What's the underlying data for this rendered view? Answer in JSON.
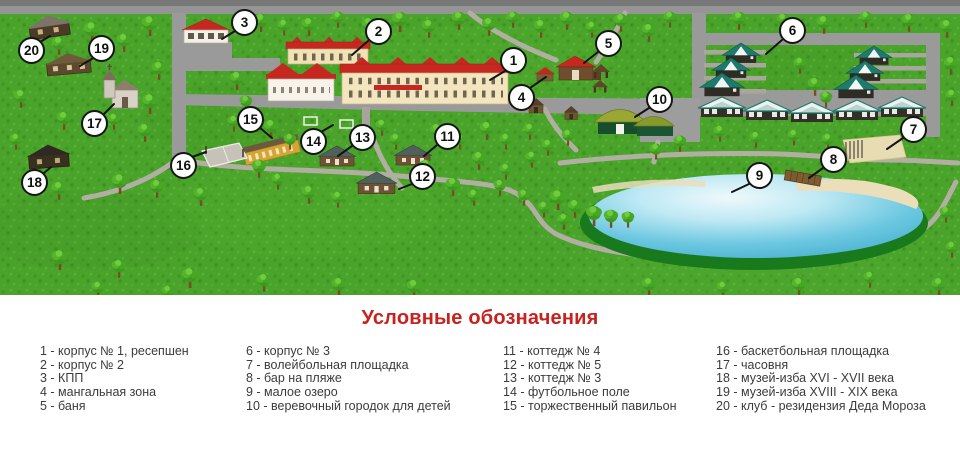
{
  "colors": {
    "accent_red": "#c8211e",
    "grass_green": "#4aa32b",
    "road_gray": "#9a9a9a",
    "lake_blue": "#5fc3de"
  },
  "callouts": [
    "1",
    "2",
    "3",
    "4",
    "5",
    "6",
    "7",
    "8",
    "9",
    "10",
    "11",
    "12",
    "13",
    "14",
    "15",
    "16",
    "17",
    "18",
    "19",
    "20"
  ],
  "legend": {
    "title": "Условные обозначения",
    "columns": [
      {
        "items": [
          "1 - корпус № 1, ресепшен",
          "2 - корпус № 2",
          "3 - КПП",
          "4 - мангальная зона",
          "5 - баня"
        ]
      },
      {
        "items": [
          "6 - корпус № 3",
          "7 - волейбольная площадка",
          "8 - бар на пляже",
          "9 - малое озеро",
          "10 - веревочный городок для детей"
        ]
      },
      {
        "items": [
          "11 - коттедж № 4",
          "12 - коттедж № 5",
          "13 - коттедж № 3",
          "14 - футбольное поле",
          "15 - торжественный павильон"
        ]
      },
      {
        "items": [
          "16 - баскетбольная площадка",
          "17 - часовня",
          "18 - музей-изба XVI - XVII века",
          "19 - музей-изба XVIII - XIX века",
          "20 - клуб - резидензия Деда Мороза"
        ]
      }
    ]
  }
}
